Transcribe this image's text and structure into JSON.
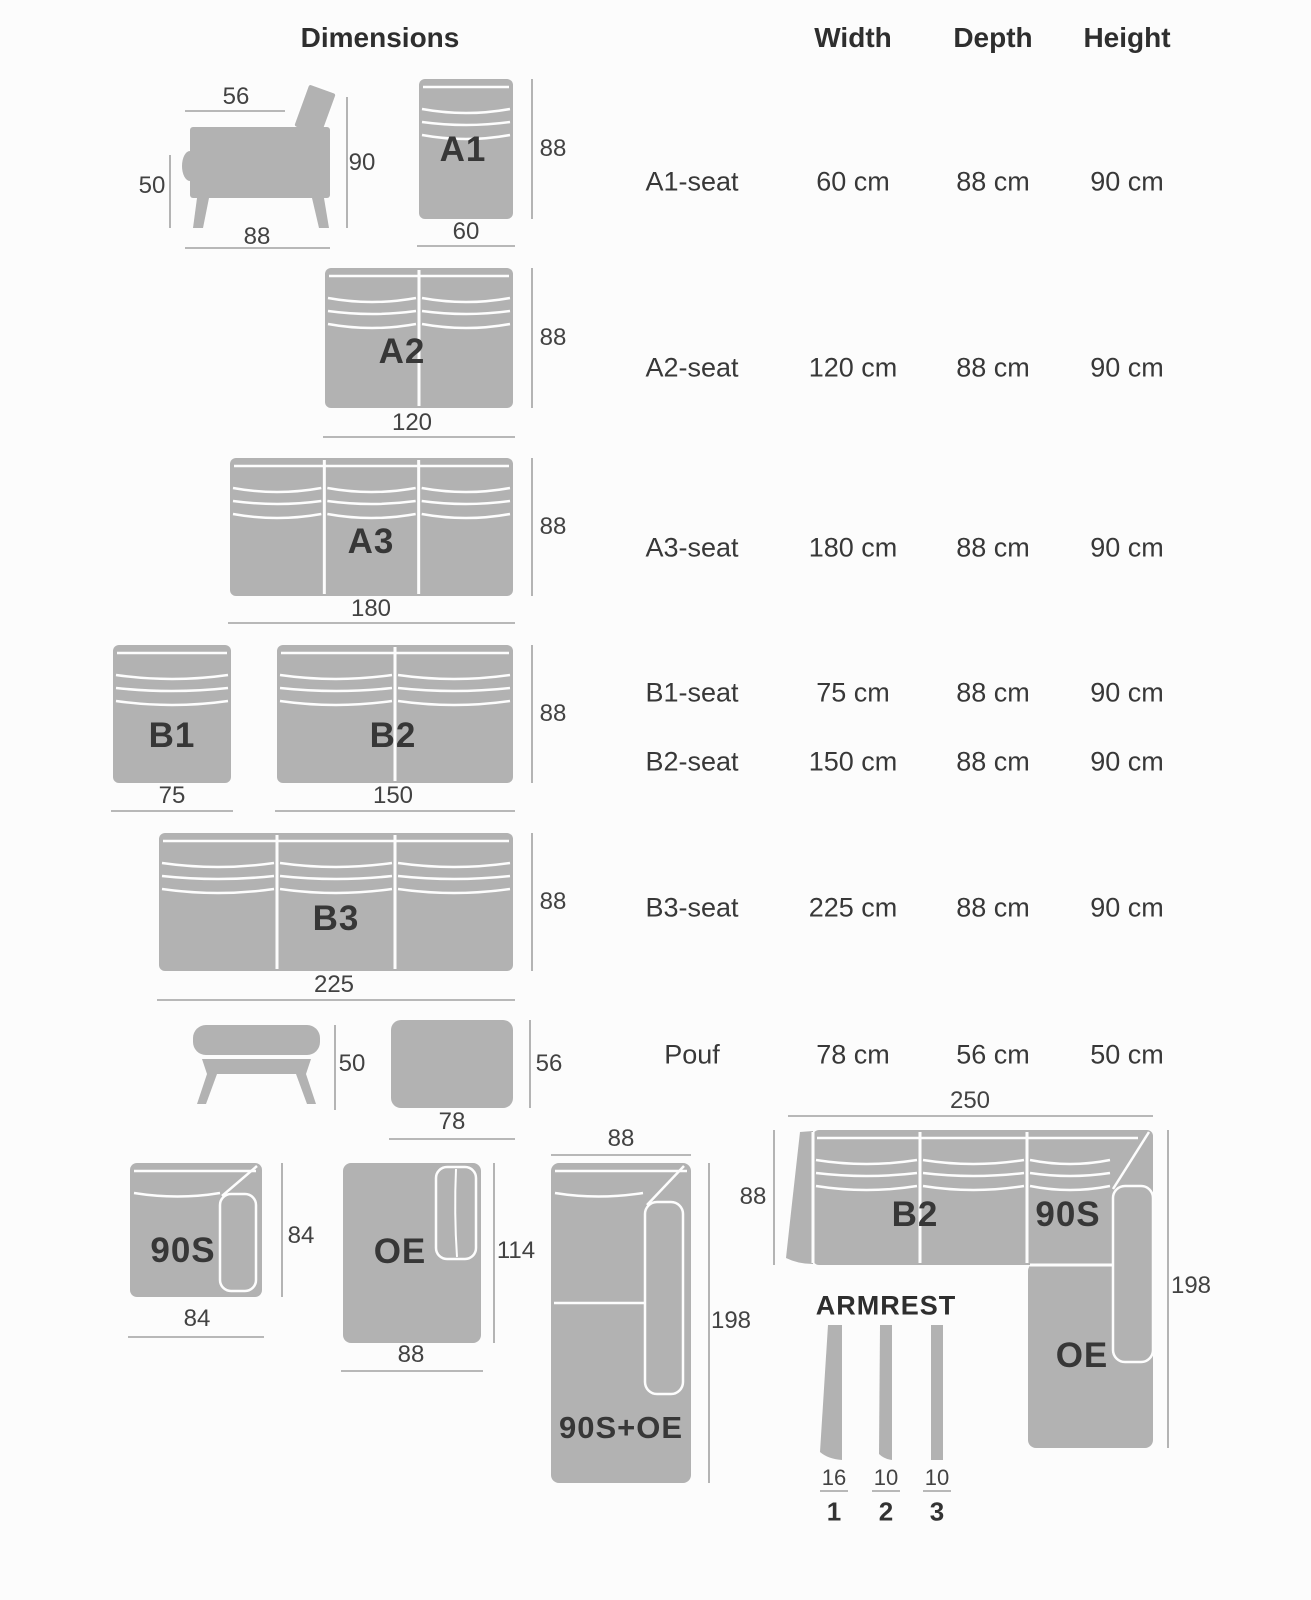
{
  "header": {
    "title": "Dimensions",
    "columns": [
      "Width",
      "Depth",
      "Height"
    ]
  },
  "table": {
    "rows": [
      {
        "label": "A1-seat",
        "width": "60 cm",
        "depth": "88 cm",
        "height": "90 cm"
      },
      {
        "label": "A2-seat",
        "width": "120 cm",
        "depth": "88 cm",
        "height": "90 cm"
      },
      {
        "label": "A3-seat",
        "width": "180 cm",
        "depth": "88 cm",
        "height": "90 cm"
      },
      {
        "label": "B1-seat",
        "width": "75 cm",
        "depth": "88 cm",
        "height": "90 cm"
      },
      {
        "label": "B2-seat",
        "width": "150 cm",
        "depth": "88 cm",
        "height": "90 cm"
      },
      {
        "label": "B3-seat",
        "width": "225 cm",
        "depth": "88 cm",
        "height": "90 cm"
      },
      {
        "label": "Pouf",
        "width": "78 cm",
        "depth": "56 cm",
        "height": "50 cm"
      }
    ]
  },
  "diagrams": {
    "side_view": {
      "seat_width": "56",
      "height": "90",
      "seat_height": "50",
      "depth": "88"
    },
    "a1": {
      "label": "A1",
      "depth": "88",
      "width": "60"
    },
    "a2": {
      "label": "A2",
      "depth": "88",
      "width": "120"
    },
    "a3": {
      "label": "A3",
      "depth": "88",
      "width": "180"
    },
    "b1": {
      "label": "B1",
      "width": "75"
    },
    "b2": {
      "label": "B2",
      "depth": "88",
      "width": "150"
    },
    "b3": {
      "label": "B3",
      "depth": "88",
      "width": "225"
    },
    "pouf": {
      "side_height": "50",
      "top_depth": "56",
      "top_width": "78"
    },
    "s90": {
      "label": "90S",
      "depth": "84",
      "width": "84"
    },
    "oe": {
      "label": "OE",
      "depth": "114",
      "width": "88"
    },
    "s90_oe": {
      "label": "90S+OE",
      "width": "88",
      "length": "198"
    },
    "corner": {
      "width": "250",
      "depth": "88",
      "length": "198",
      "b2_label": "B2",
      "s90_label": "90S",
      "oe_label": "OE"
    },
    "armrest": {
      "title": "ARMREST",
      "widths": [
        "16",
        "10",
        "10"
      ],
      "indices": [
        "1",
        "2",
        "3"
      ]
    }
  },
  "colors": {
    "background": "#fcfcfc",
    "module_fill": "#b2b2b2",
    "seam": "#fdfdfd",
    "dim_line": "#a2a2a2",
    "text": "#3d3d3d"
  }
}
